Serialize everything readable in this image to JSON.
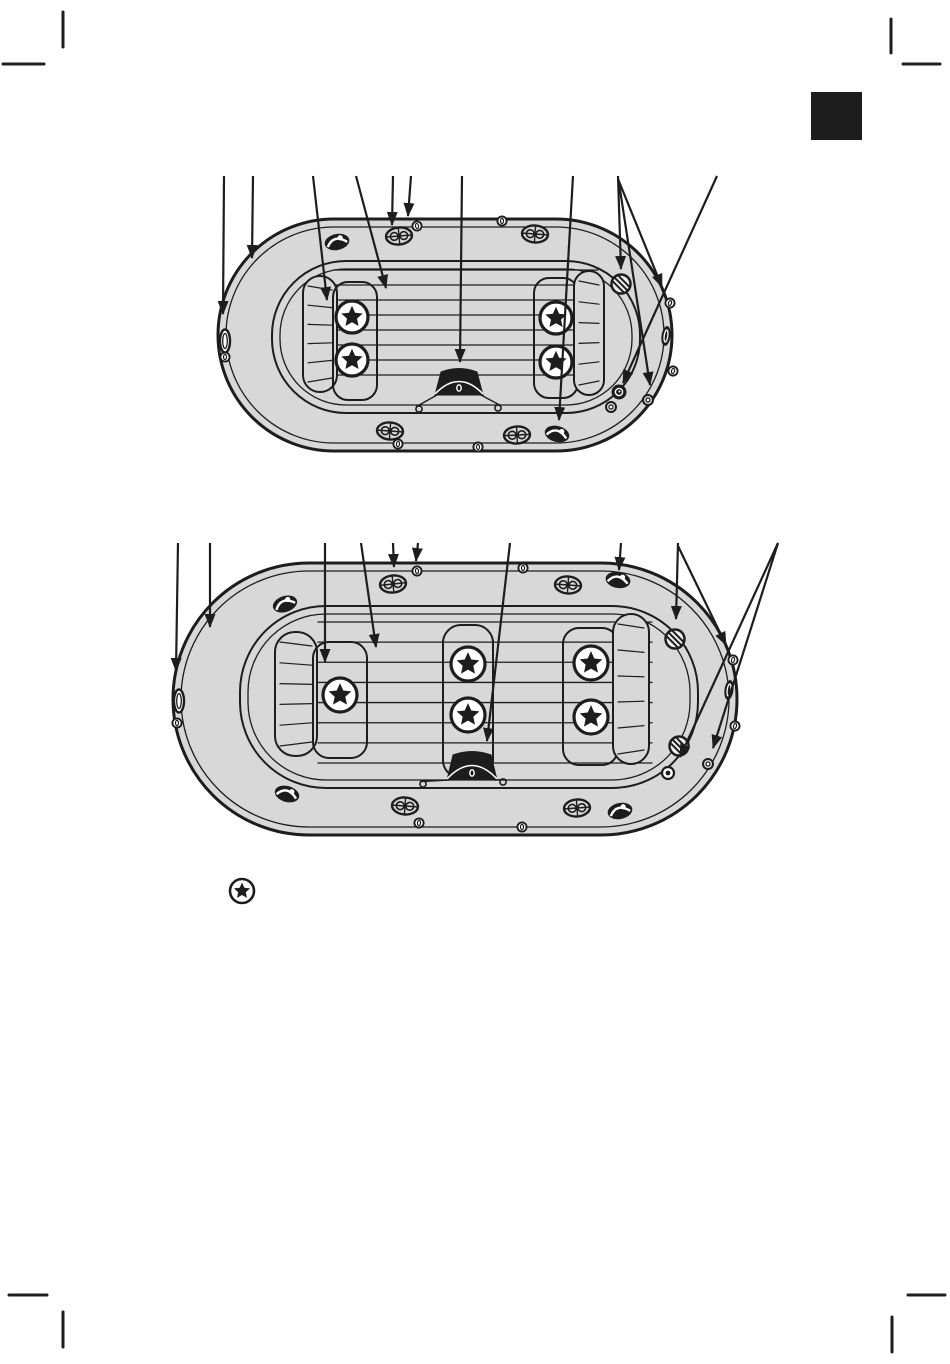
{
  "page": {
    "width": 950,
    "height": 1364,
    "background": "#ffffff"
  },
  "style": {
    "ink": "#1d1d1d",
    "boat_fill": "#d8d8d8",
    "hatch_fill": "#ececec",
    "white": "#ffffff"
  },
  "section_tab": {
    "name": "chapter-tab-marker",
    "x": 811,
    "y": 92,
    "width": 51,
    "height": 48,
    "color": "#1d1d1d"
  },
  "footnote_marker": {
    "icon": "star-in-circle-icon",
    "x": 242,
    "y": 891,
    "radius": 12,
    "star_radius": 8.5
  },
  "print_marks": {
    "color": "#1d1d1d",
    "stroke": 3,
    "marks": [
      {
        "name": "crop-mark-top-left-v",
        "x1": 63,
        "y1": 12,
        "x2": 63,
        "y2": 47
      },
      {
        "name": "crop-mark-top-left-h",
        "x1": 3,
        "y1": 64,
        "x2": 44,
        "y2": 64
      },
      {
        "name": "crop-mark-top-right-v",
        "x1": 891,
        "y1": 19,
        "x2": 891,
        "y2": 53
      },
      {
        "name": "crop-mark-top-right-h",
        "x1": 903,
        "y1": 64,
        "x2": 940,
        "y2": 64
      },
      {
        "name": "crop-mark-bottom-left-h",
        "x1": 9,
        "y1": 1295,
        "x2": 47,
        "y2": 1295
      },
      {
        "name": "crop-mark-bottom-left-v",
        "x1": 63,
        "y1": 1312,
        "x2": 63,
        "y2": 1347
      },
      {
        "name": "crop-mark-bottom-right-h",
        "x1": 908,
        "y1": 1295,
        "x2": 945,
        "y2": 1295
      },
      {
        "name": "crop-mark-bottom-right-v",
        "x1": 892,
        "y1": 1317,
        "x2": 892,
        "y2": 1352
      }
    ]
  },
  "boats": [
    {
      "name": "boat-diagram-two-bench",
      "hull": {
        "x": 218,
        "y": 219,
        "w": 454,
        "h": 232
      },
      "seam_inset": 8,
      "cockpit": {
        "x": 272,
        "y": 261,
        "w": 368,
        "h": 152,
        "r": 74
      },
      "floor_inset": 8,
      "floor_lines": {
        "x1": 334,
        "x2": 598,
        "y_first": 270,
        "y_last": 375,
        "count": 8
      },
      "benches": [
        {
          "kind": "hatched",
          "x": 303,
          "y": 276,
          "w": 34,
          "h": 116,
          "r": 17
        },
        {
          "kind": "panel",
          "x": 333,
          "y": 282,
          "w": 44,
          "h": 118,
          "r": 15
        },
        {
          "kind": "panel",
          "x": 534,
          "y": 278,
          "w": 44,
          "h": 120,
          "r": 15
        },
        {
          "kind": "hatched",
          "x": 574,
          "y": 271,
          "w": 30,
          "h": 124,
          "r": 15
        }
      ],
      "star_radius": 16,
      "stars": [
        {
          "x": 352,
          "y": 317
        },
        {
          "x": 352,
          "y": 360
        },
        {
          "x": 556,
          "y": 318
        },
        {
          "x": 556,
          "y": 362
        }
      ],
      "pouch": {
        "cx": 459,
        "cy": 382,
        "w": 48,
        "h": 26,
        "rope_rings": [
          [
            419,
            409
          ],
          [
            498,
            408
          ]
        ]
      },
      "parts": [
        {
          "type": "bow-cap",
          "x": 225,
          "y": 341,
          "rot": 0
        },
        {
          "type": "grommet",
          "x": 225,
          "y": 357,
          "rot": 0
        },
        {
          "type": "grab-handle",
          "x": 337,
          "y": 242,
          "rot": -12
        },
        {
          "type": "oar-lock",
          "x": 399,
          "y": 236,
          "rot": -5
        },
        {
          "type": "grommet",
          "x": 417,
          "y": 226,
          "rot": -10
        },
        {
          "type": "grommet",
          "x": 502,
          "y": 221,
          "rot": 0
        },
        {
          "type": "oar-lock",
          "x": 535,
          "y": 234,
          "rot": 4
        },
        {
          "type": "screw-hatch",
          "x": 621,
          "y": 284,
          "rot": 0
        },
        {
          "type": "grommet",
          "x": 670,
          "y": 303,
          "rot": 15
        },
        {
          "type": "edge-oval",
          "x": 666,
          "y": 336,
          "rot": 8
        },
        {
          "type": "grommet",
          "x": 673,
          "y": 371,
          "rot": 15
        },
        {
          "type": "valve",
          "x": 619,
          "y": 392,
          "rot": 0
        },
        {
          "type": "small-ring",
          "x": 611,
          "y": 407,
          "rot": 0
        },
        {
          "type": "small-ring",
          "x": 648,
          "y": 400,
          "rot": 0
        },
        {
          "type": "grab-handle",
          "x": 557,
          "y": 434,
          "rot": 14
        },
        {
          "type": "oar-lock",
          "x": 390,
          "y": 431,
          "rot": 4
        },
        {
          "type": "oar-lock",
          "x": 517,
          "y": 435,
          "rot": -3
        },
        {
          "type": "grommet",
          "x": 398,
          "y": 444,
          "rot": 8
        },
        {
          "type": "grommet",
          "x": 478,
          "y": 447,
          "rot": 0
        }
      ],
      "arrows": [
        [
          224,
          176,
          223,
          314
        ],
        [
          253,
          176,
          252,
          258
        ],
        [
          313,
          176,
          327,
          300
        ],
        [
          356,
          176,
          386,
          288
        ],
        [
          393,
          176,
          392,
          225
        ],
        [
          411,
          176,
          408,
          216
        ],
        [
          462,
          176,
          460,
          362
        ],
        [
          573,
          176,
          559,
          420
        ],
        [
          618,
          176,
          621,
          269
        ],
        [
          618,
          179,
          662,
          287
        ],
        [
          619,
          183,
          650,
          385
        ],
        [
          717,
          176,
          623,
          383
        ]
      ]
    },
    {
      "name": "boat-diagram-three-bench",
      "hull": {
        "x": 173,
        "y": 563,
        "w": 564,
        "h": 272
      },
      "seam_inset": 8,
      "cockpit": {
        "x": 240,
        "y": 606,
        "w": 458,
        "h": 182,
        "r": 86
      },
      "floor_inset": 8,
      "floor_lines": {
        "x1": 318,
        "x2": 652,
        "y_first": 622,
        "y_last": 763,
        "count": 8
      },
      "benches": [
        {
          "kind": "hatched",
          "x": 275,
          "y": 632,
          "w": 42,
          "h": 124,
          "r": 20
        },
        {
          "kind": "panel",
          "x": 313,
          "y": 642,
          "w": 54,
          "h": 116,
          "r": 16
        },
        {
          "kind": "panel",
          "x": 443,
          "y": 625,
          "w": 50,
          "h": 153,
          "r": 18
        },
        {
          "kind": "panel",
          "x": 563,
          "y": 628,
          "w": 55,
          "h": 137,
          "r": 16
        },
        {
          "kind": "hatched",
          "x": 613,
          "y": 614,
          "w": 36,
          "h": 150,
          "r": 18
        }
      ],
      "star_radius": 17,
      "stars": [
        {
          "x": 340,
          "y": 695
        },
        {
          "x": 468,
          "y": 664
        },
        {
          "x": 468,
          "y": 715
        },
        {
          "x": 591,
          "y": 663
        },
        {
          "x": 591,
          "y": 717
        }
      ],
      "pouch": {
        "cx": 472,
        "cy": 766,
        "w": 50,
        "h": 28,
        "rope_rings": [
          [
            423,
            784
          ],
          [
            503,
            782
          ]
        ]
      },
      "parts": [
        {
          "type": "bow-cap",
          "x": 179,
          "y": 701,
          "rot": 0
        },
        {
          "type": "grommet",
          "x": 177,
          "y": 723,
          "rot": 0
        },
        {
          "type": "grab-handle",
          "x": 285,
          "y": 604,
          "rot": -18
        },
        {
          "type": "oar-lock",
          "x": 393,
          "y": 584,
          "rot": -6
        },
        {
          "type": "grommet",
          "x": 417,
          "y": 571,
          "rot": -8
        },
        {
          "type": "grommet",
          "x": 523,
          "y": 568,
          "rot": 0
        },
        {
          "type": "oar-lock",
          "x": 568,
          "y": 585,
          "rot": 4
        },
        {
          "type": "grab-handle",
          "x": 618,
          "y": 580,
          "rot": 10
        },
        {
          "type": "screw-hatch",
          "x": 675,
          "y": 639,
          "rot": 0
        },
        {
          "type": "grommet",
          "x": 733,
          "y": 660,
          "rot": 15
        },
        {
          "type": "edge-oval",
          "x": 729,
          "y": 690,
          "rot": 8
        },
        {
          "type": "grommet",
          "x": 735,
          "y": 726,
          "rot": 15
        },
        {
          "type": "screw-hatch",
          "x": 679,
          "y": 746,
          "rot": 0
        },
        {
          "type": "drain-ring",
          "x": 668,
          "y": 773,
          "rot": 0
        },
        {
          "type": "small-ring",
          "x": 708,
          "y": 764,
          "rot": 0
        },
        {
          "type": "grab-handle",
          "x": 287,
          "y": 794,
          "rot": 16
        },
        {
          "type": "oar-lock",
          "x": 405,
          "y": 806,
          "rot": 4
        },
        {
          "type": "oar-lock",
          "x": 577,
          "y": 808,
          "rot": -4
        },
        {
          "type": "grommet",
          "x": 419,
          "y": 823,
          "rot": 5
        },
        {
          "type": "grommet",
          "x": 522,
          "y": 827,
          "rot": 0
        },
        {
          "type": "grab-handle",
          "x": 620,
          "y": 811,
          "rot": -12
        }
      ],
      "arrows": [
        [
          178,
          543,
          176,
          671
        ],
        [
          210,
          543,
          210,
          627
        ],
        [
          325,
          543,
          325,
          662
        ],
        [
          361,
          543,
          376,
          647
        ],
        [
          393,
          543,
          394,
          567
        ],
        [
          418,
          543,
          416,
          561
        ],
        [
          510,
          543,
          487,
          741
        ],
        [
          621,
          543,
          619,
          570
        ],
        [
          678,
          543,
          676,
          619
        ],
        [
          678,
          546,
          726,
          645
        ],
        [
          778,
          543,
          680,
          757
        ],
        [
          778,
          543,
          713,
          748
        ]
      ]
    }
  ]
}
